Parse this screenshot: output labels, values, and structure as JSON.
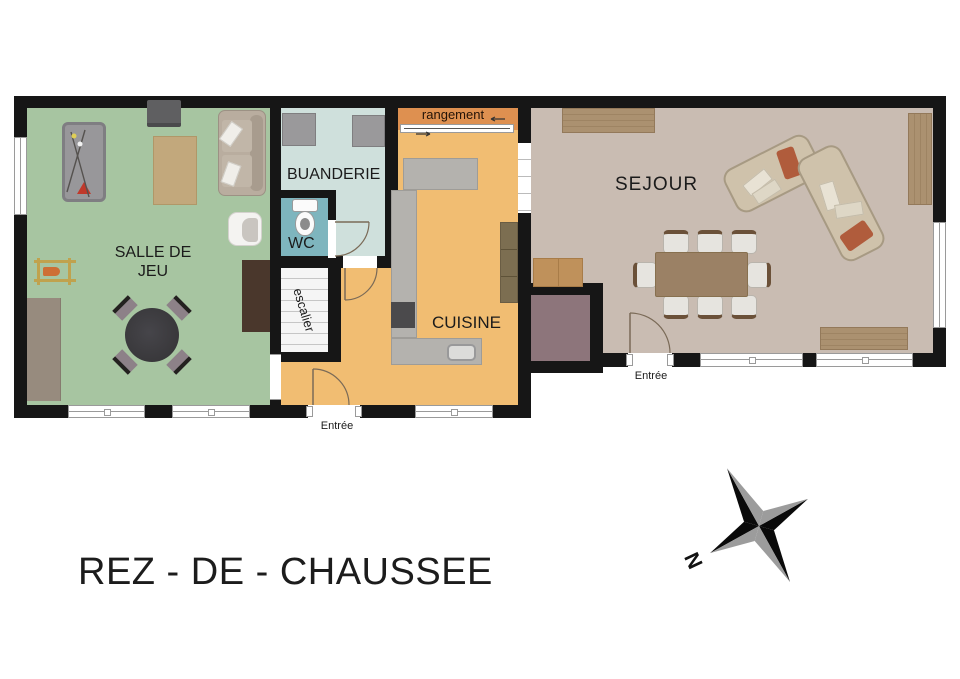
{
  "title": "REZ - DE - CHAUSSEE",
  "compass": {
    "north_label": "N"
  },
  "rooms": {
    "salle_de_jeu": {
      "label": "SALLE DE JEU"
    },
    "buanderie": {
      "label": "BUANDERIE"
    },
    "wc": {
      "label": "WC"
    },
    "escalier": {
      "label": "escalier"
    },
    "rangement": {
      "label": "rangement"
    },
    "cuisine": {
      "label": "CUISINE"
    },
    "sejour": {
      "label": "SEJOUR"
    }
  },
  "doors": {
    "entrance_kitchen": "Entrée",
    "entrance_sejour": "Entrée"
  },
  "colors": {
    "wall": "#161616",
    "game": "#a7c5a1",
    "buanderie": "#cfe0dc",
    "wc": "#7eb5be",
    "kitchen": "#f1bd72",
    "rangement": "#de9050",
    "sejour": "#c9bcb2",
    "vestibule": "#8d757b",
    "counter": "#b4b2ae",
    "arc": "#7a6a57"
  }
}
